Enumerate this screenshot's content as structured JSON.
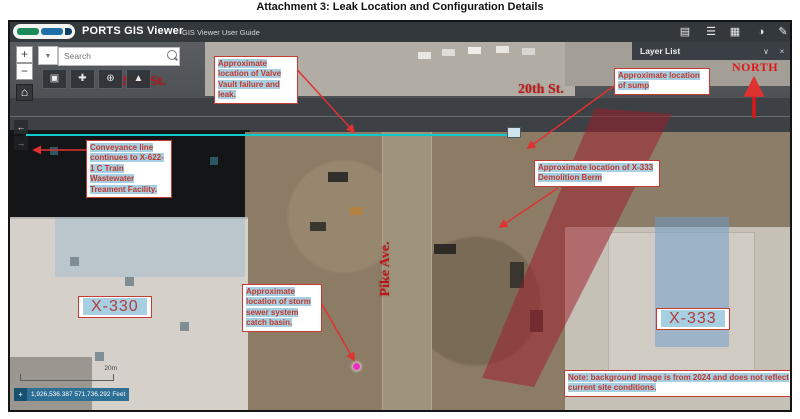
{
  "page_title": "Attachment 3: Leak Location and Configuration Details",
  "header": {
    "app_title": "PORTS GIS Viewer",
    "user_guide": "GIS Viewer User Guide"
  },
  "toolbar": {
    "zoom_in": "+",
    "zoom_out": "−",
    "search_placeholder": "Search"
  },
  "icons": {
    "layers": "▤",
    "legend": "☰",
    "basemap_gallery": "▦",
    "palette": "◑",
    "pencil": "✎",
    "home": "⌂",
    "dropdown": "▼",
    "collapse": "∨",
    "close": "×",
    "panel_left": "←",
    "panel_right": "→",
    "tool_basemap": "▣",
    "tool_add": "✚",
    "tool_zoombox": "⊕",
    "tool_route": "▲",
    "crosshair": "+"
  },
  "layer_panel": {
    "title": "Layer List"
  },
  "map": {
    "street_20th_west": "20th St.",
    "street_20th_east": "20th St.",
    "street_pike": "Pike Ave.",
    "north_label": "NORTH",
    "building_x330": "X-330",
    "building_x333": "X-333",
    "annotations": {
      "valve_vault": "Approximate location of Valve Vault failure and leak.",
      "sump": "Approximate location of sump",
      "conveyance": "Conveyance line continues to X-622-1 C Train Wastewater Treament Facility.",
      "berm": "Approximate location of X-333 Demolition Berm",
      "catch_basin": "Approximate location of storm sewer system catch basin.",
      "note": "Note: background image is from 2024 and does not reflect current site conditions."
    },
    "scale_label": "20m",
    "coordinates": "1,926,536.387 571,736.292 Feet"
  },
  "colors": {
    "annotation_red": "#c2372a",
    "highlight_blue": "#a7cfe2",
    "conveyance_teal": "#10c9c9",
    "berm_fill": "rgba(158,28,42,0.52)",
    "north_red": "#e01616",
    "appbar": "#33383c"
  }
}
